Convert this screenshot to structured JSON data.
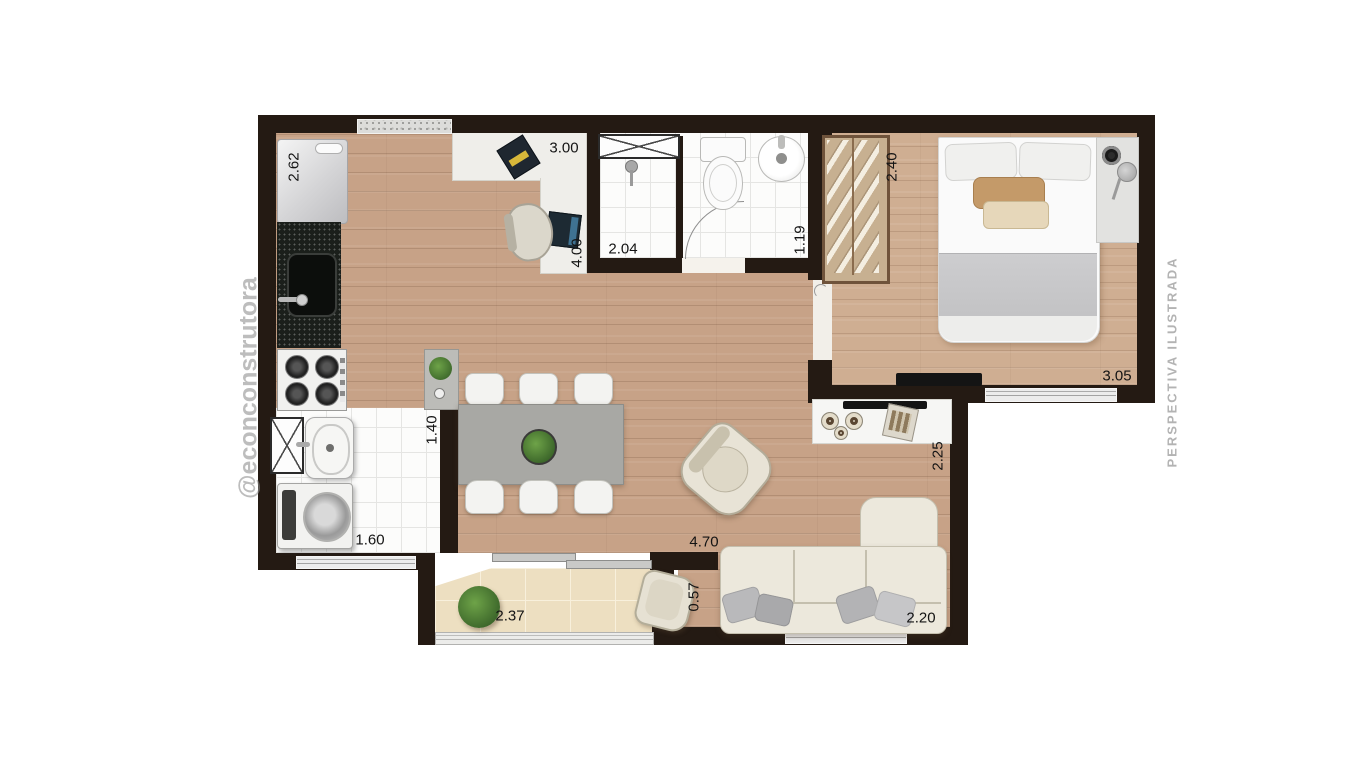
{
  "watermarks": {
    "left": "@econconstrutora",
    "right": "PERSPECTIVA ILUSTRADA"
  },
  "labels": {
    "dim_fridge_wall": "2.62",
    "dim_kitchen_width": "3.00",
    "dim_kitchen_depth": "4.00",
    "dim_shower": "2.04",
    "dim_bath_width": "1.19",
    "dim_wardrobe_wall": "2.40",
    "dim_bedroom_width": "3.05",
    "dim_service_depth": "1.40",
    "dim_service_width": "1.60",
    "dim_tv_wall": "2.25",
    "dim_living_length": "4.70",
    "dim_balcony_depth": "0.57",
    "dim_balcony_width": "2.37",
    "dim_sofa_wall": "2.20"
  },
  "colors": {
    "wall": "#241a13",
    "floor_wood": "#c7a287",
    "floor_bedroom": "#cfae92",
    "balcony_tile": "#eddfc1",
    "plant_green": "#4e7d38",
    "watermark_gray": "#a0a0a0"
  }
}
